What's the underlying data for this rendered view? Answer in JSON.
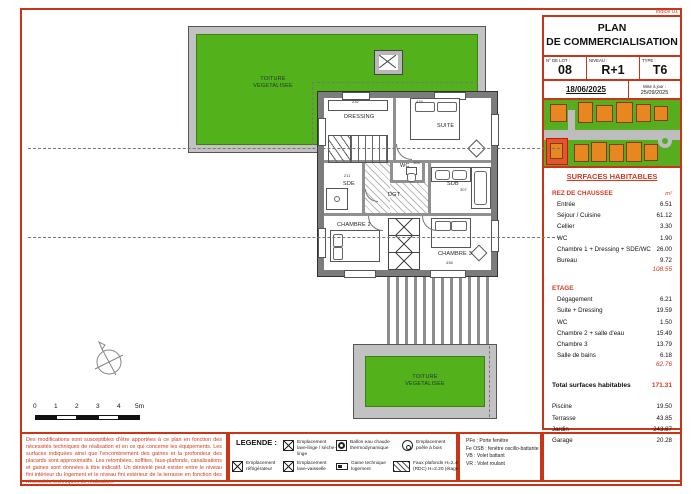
{
  "header": {
    "indice": "Indice 01",
    "title_line1": "PLAN",
    "title_line2": "DE COMMERCIALISATION",
    "lot_label": "N° DE LOT :",
    "lot_value": "08",
    "niveau_label": "NIVEAU :",
    "niveau_value": "R+1",
    "type_label": "TYPE :",
    "type_value": "T6",
    "date": "18/06/2025",
    "maj_label": "Mise à jour :",
    "maj_value": "25/09/2025"
  },
  "surfaces": {
    "title": "SURFACES HABITABLES",
    "rdc": {
      "label": "REZ DE CHAUSSEE",
      "unit": "m²",
      "rows": [
        {
          "label": "Entrée",
          "value": "6.51"
        },
        {
          "label": "Séjour / Cuisine",
          "value": "61.12"
        },
        {
          "label": "Cellier",
          "value": "3.30"
        },
        {
          "label": "WC",
          "value": "1.90"
        },
        {
          "label": "Chambre 1 + Dressing + SDE/WC",
          "value": "26.00"
        },
        {
          "label": "Bureau",
          "value": "9.72"
        }
      ],
      "subtotal": "108.55"
    },
    "etage": {
      "label": "ETAGE",
      "rows": [
        {
          "label": "Dégagement",
          "value": "6.21"
        },
        {
          "label": "Suite + Dressing",
          "value": "19.59"
        },
        {
          "label": "WC",
          "value": "1.50"
        },
        {
          "label": "Chambre 2 + salle d'eau",
          "value": "15.49"
        },
        {
          "label": "Chambre 3",
          "value": "13.79"
        },
        {
          "label": "Salle de bains",
          "value": "6.18"
        }
      ],
      "subtotal": "62.76"
    },
    "total_label": "Total surfaces habitables",
    "total_value": "171.31",
    "annexes": [
      {
        "label": "Piscine",
        "value": "19.50"
      },
      {
        "label": "Terrasse",
        "value": "43.85"
      },
      {
        "label": "Jardin",
        "value": "243.87"
      },
      {
        "label": "Garage",
        "value": "20.28"
      }
    ]
  },
  "plan": {
    "roof_top_1": "TOITURE",
    "roof_top_2": "VEGETALISEE",
    "roof_bottom_1": "TOITURE",
    "roof_bottom_2": "VEGETALISEE",
    "rooms": {
      "dressing": "DRESSING",
      "suite": "SUITE",
      "sde": "SDE",
      "wc": "WC",
      "sdb": "SDB",
      "dgt": "DGT",
      "chambre2": "CHAMBRE 2",
      "chambre3": "CHAMBRE 3"
    },
    "dims": [
      "232",
      "479",
      "211",
      "104",
      "307",
      "436"
    ]
  },
  "scalebar": {
    "ticks": [
      "0",
      "1",
      "2",
      "3",
      "4",
      "5m"
    ]
  },
  "disclaimer": "Des modifications sont susceptibles d'être apportées à ce plan en fonction des nécessités techniques de réalisation et en ce qui concerne les équipements. Les surfaces indiquées ainsi que l'encombrement des gaines et la profondeur des placards sont approximatifs. Les retombées, soffites, faux-plafonds, canalisations et gaines sont données à titre indicatif. Un dénivelé peut exister entre le niveau fini intérieur du logement et le niveau fini extérieur de la terrasse en fonction des nécessités techniques de réalisation.",
  "legend": {
    "title": "LEGENDE :",
    "items": [
      {
        "label": "Emplacement lave-linge / sèche-linge"
      },
      {
        "label": "Ballon eau chaude thermodynamique"
      },
      {
        "label": "Emplacement poêle à bois"
      },
      {
        "label": "Emplacement réfrigérateur"
      },
      {
        "label": "Emplacement lave-vaisselle"
      },
      {
        "label": "Gaine technique logement"
      },
      {
        "label": "Faux plafonds H=2.40 (RDC) H=2.20 (étage)"
      }
    ],
    "abbr1": "PFe : Porte fenêtre",
    "abbr2": "Fe OSB : fenêtre oscillo-battante",
    "abbr3": "VB : Volet battant",
    "abbr4": "VR : Volet roulant"
  },
  "colors": {
    "accent_red": "#c93617",
    "roof_green": "#53b21c"
  }
}
